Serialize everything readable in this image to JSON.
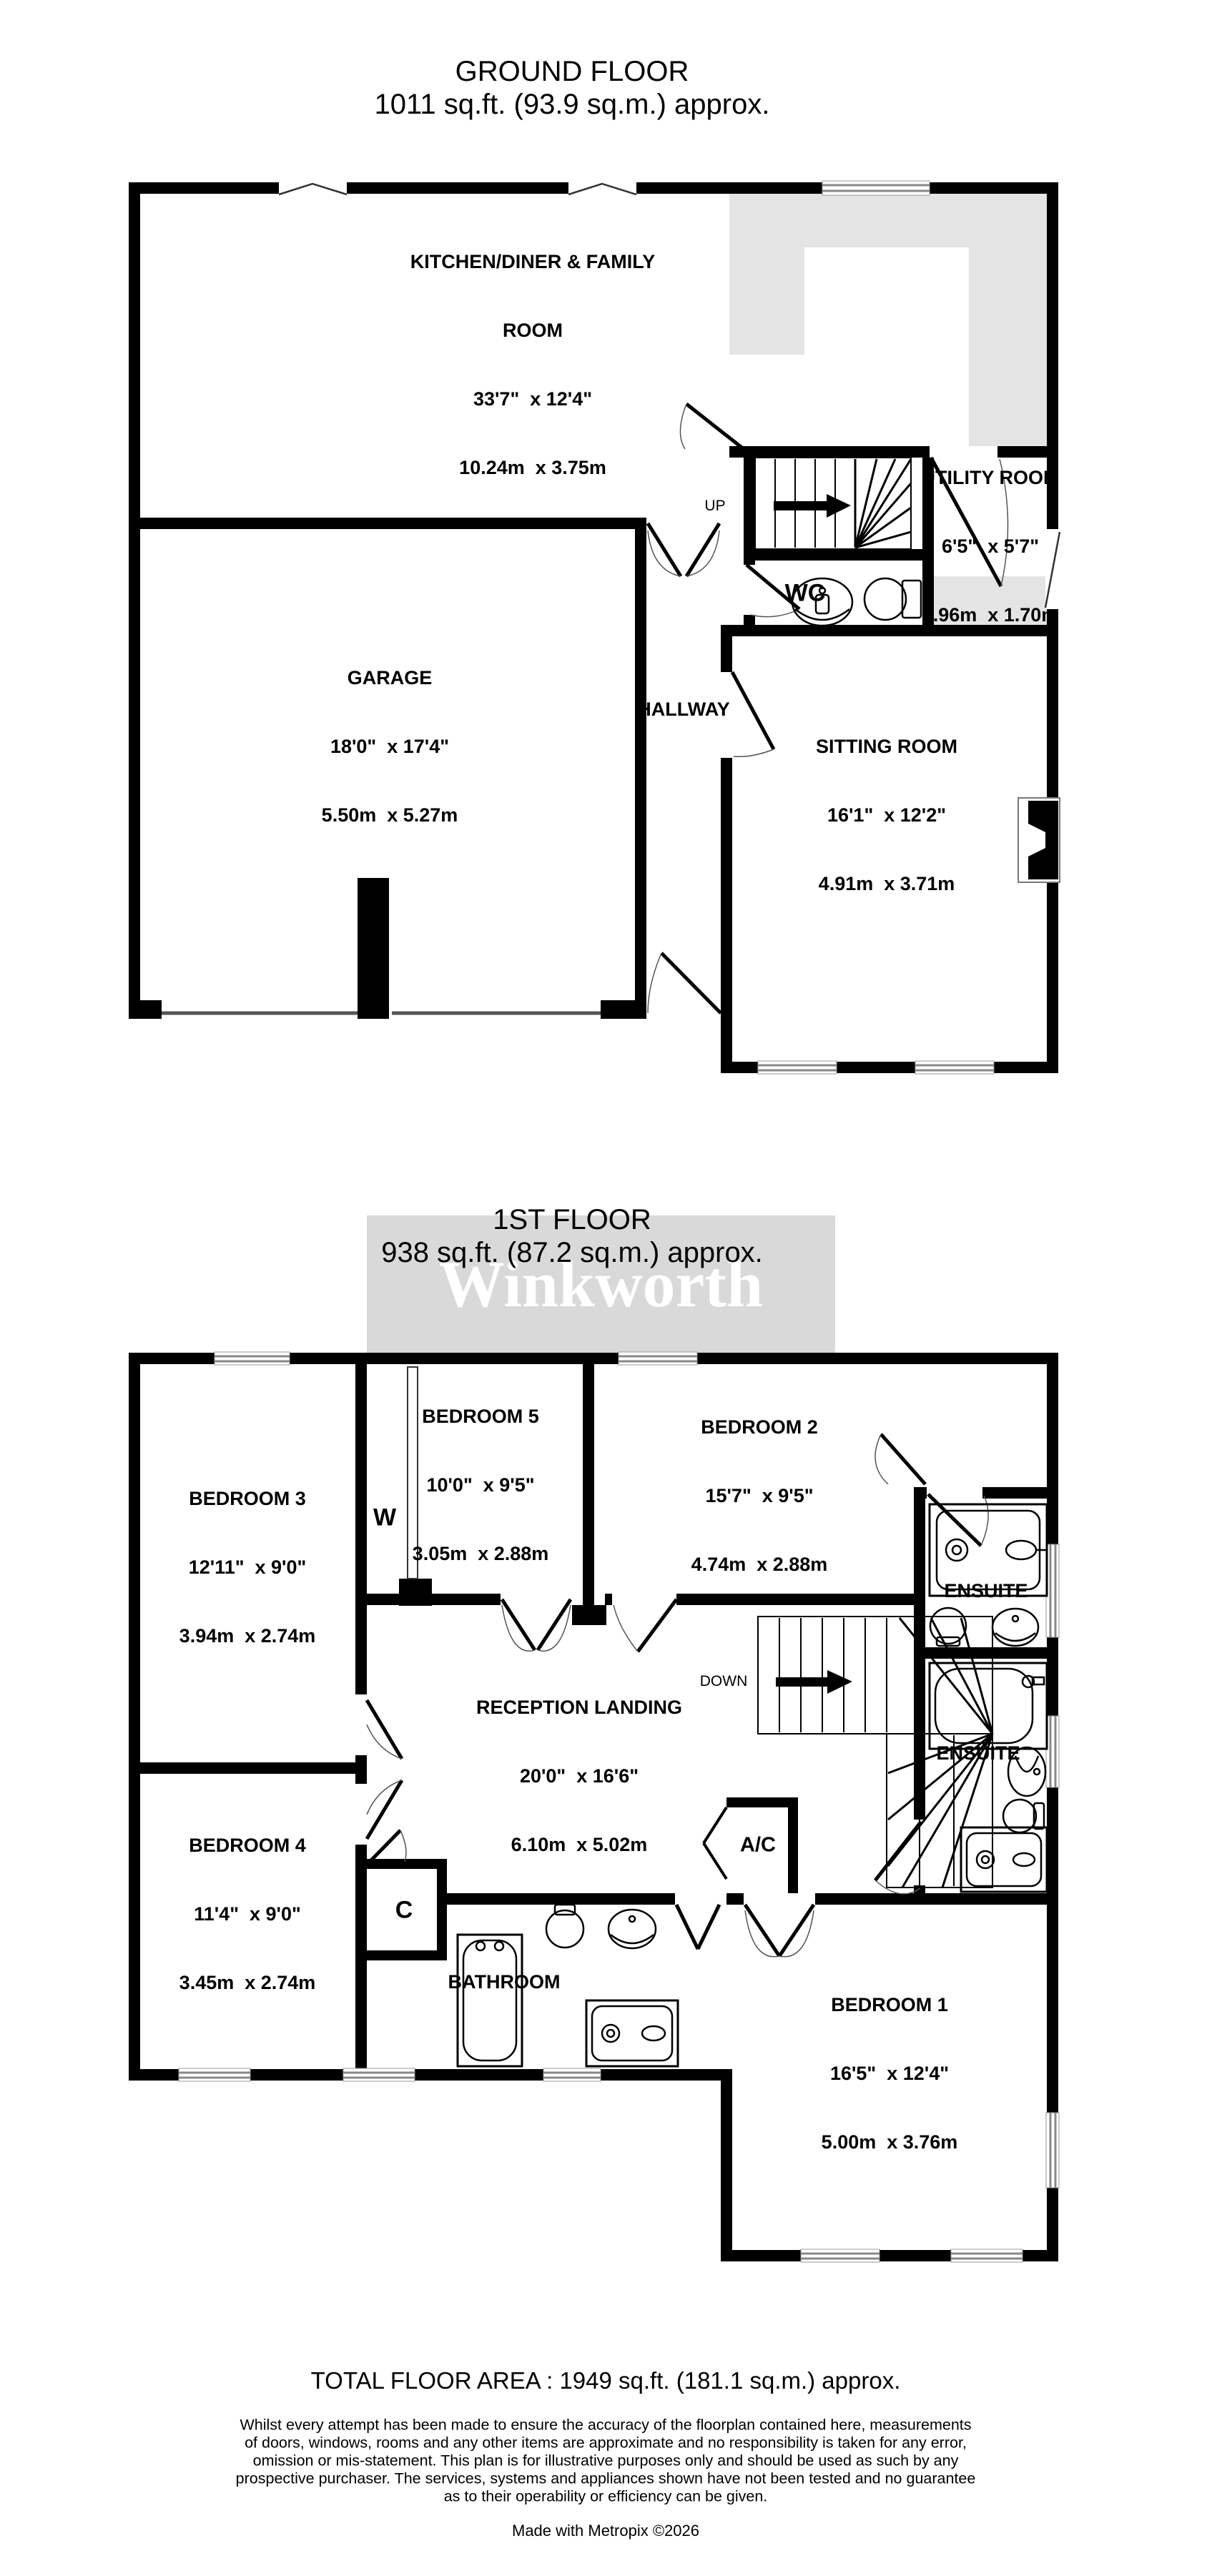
{
  "page": {
    "background": "#ffffff",
    "wall_color": "#000000",
    "counter_color": "#e4e4e4",
    "watermark_box_color": "#d9d9d9"
  },
  "watermark": {
    "text": "Winkworth"
  },
  "ground_floor": {
    "title": "GROUND FLOOR",
    "subtitle": "1011 sq.ft. (93.9 sq.m.) approx.",
    "rooms": {
      "kitchen": {
        "name": "KITCHEN/DINER & FAMILY",
        "name2": "ROOM",
        "imperial": "33'7\"  x 12'4\"",
        "metric": "10.24m  x 3.75m"
      },
      "garage": {
        "name": "GARAGE",
        "imperial": "18'0\"  x 17'4\"",
        "metric": "5.50m  x 5.27m"
      },
      "sitting": {
        "name": "SITTING ROOM",
        "imperial": "16'1\"  x 12'2\"",
        "metric": "4.91m  x 3.71m"
      },
      "utility": {
        "name": "UTILITY ROOM",
        "imperial": "6'5\"  x 5'7\"",
        "metric": "1.96m  x 1.70m"
      },
      "hallway": {
        "name": "HALLWAY"
      },
      "wc": {
        "name": "WC"
      }
    },
    "stairs_label": "UP"
  },
  "first_floor": {
    "title": "1ST FLOOR",
    "subtitle": "938 sq.ft. (87.2 sq.m.) approx.",
    "rooms": {
      "bedroom1": {
        "name": "BEDROOM 1",
        "imperial": "16'5\"  x 12'4\"",
        "metric": "5.00m  x 3.76m"
      },
      "bedroom2": {
        "name": "BEDROOM 2",
        "imperial": "15'7\"  x 9'5\"",
        "metric": "4.74m  x 2.88m"
      },
      "bedroom3": {
        "name": "BEDROOM 3",
        "imperial": "12'11\"  x 9'0\"",
        "metric": "3.94m  x 2.74m"
      },
      "bedroom4": {
        "name": "BEDROOM 4",
        "imperial": "11'4\"  x 9'0\"",
        "metric": "3.45m  x 2.74m"
      },
      "bedroom5": {
        "name": "BEDROOM 5",
        "imperial": "10'0\"  x 9'5\"",
        "metric": "3.05m  x 2.88m"
      },
      "landing": {
        "name": "RECEPTION LANDING",
        "imperial": "20'0\"  x 16'6\"",
        "metric": "6.10m  x 5.02m"
      },
      "ensuite_top": {
        "name": "ENSUITE"
      },
      "ensuite_mid": {
        "name": "ENSUITE"
      },
      "bathroom": {
        "name": "BATHROOM"
      },
      "wardrobe": {
        "name": "W"
      },
      "cupboard": {
        "name": "C"
      },
      "airing_cupboard": {
        "name": "A/C"
      }
    },
    "stairs_label": "DOWN"
  },
  "footer": {
    "total": "TOTAL FLOOR AREA : 1949 sq.ft. (181.1 sq.m.) approx.",
    "disclaimer": [
      "Whilst every attempt has been made to ensure the accuracy of the floorplan contained here, measurements",
      "of doors, windows, rooms and any other items are approximate and no responsibility is taken for any error,",
      "omission or mis-statement. This plan is for illustrative purposes only and should be used as such by any",
      "prospective purchaser. The services, systems and appliances shown have not been tested and no guarantee",
      "as to their operability or efficiency can be given."
    ],
    "credit": "Made with Metropix ©2026"
  }
}
